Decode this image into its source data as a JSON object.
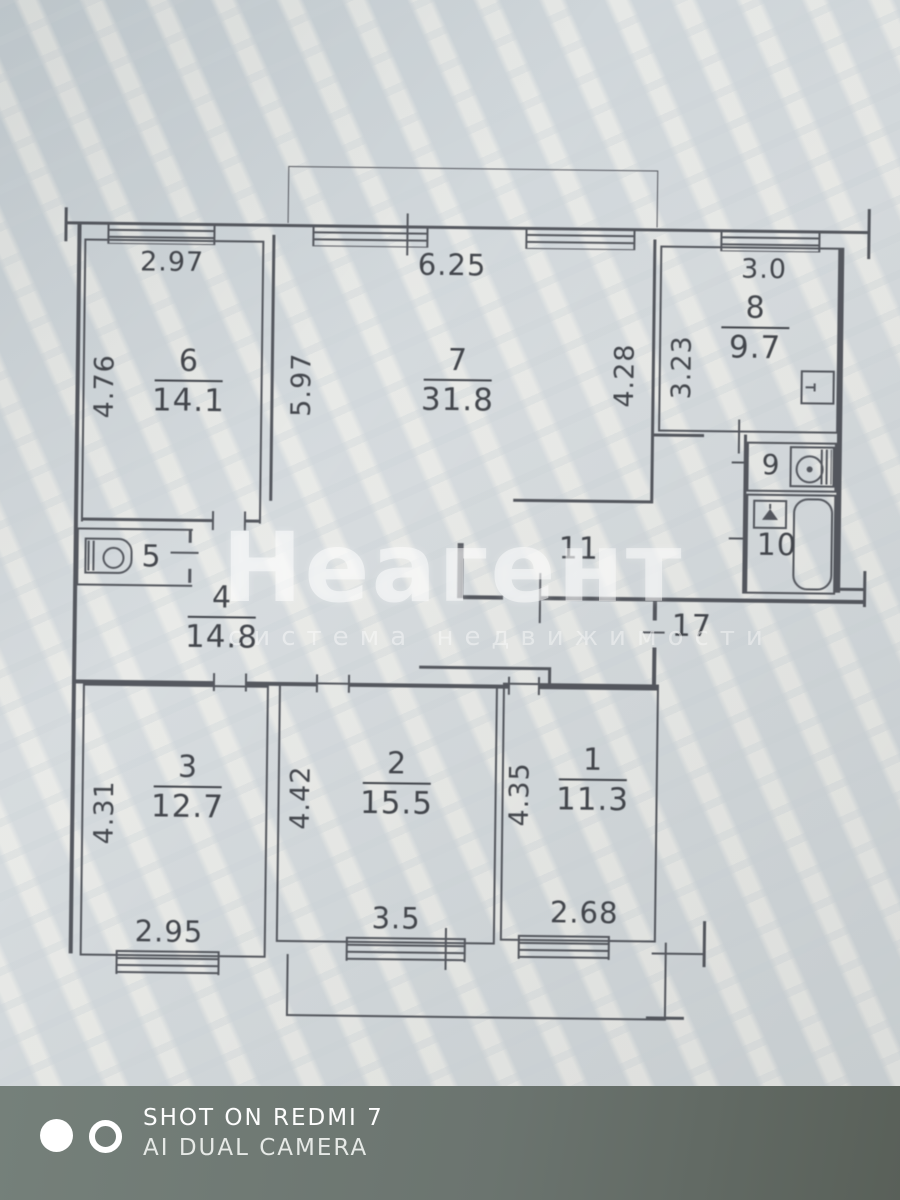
{
  "floorplan": {
    "rooms": {
      "r1": {
        "number": "1",
        "area": "11.3",
        "side": "4.35",
        "bottom": "2.68"
      },
      "r2": {
        "number": "2",
        "area": "15.5",
        "side": "4.42",
        "bottom": "3.5"
      },
      "r3": {
        "number": "3",
        "area": "12.7",
        "side": "4.31",
        "bottom": "2.95"
      },
      "r4": {
        "number": "4",
        "area": "14.8"
      },
      "r5": {
        "number": "5"
      },
      "r6": {
        "number": "6",
        "area": "14.1",
        "top": "2.97",
        "side": "4.76"
      },
      "r7": {
        "number": "7",
        "area": "31.8",
        "top": "6.25",
        "side": "5.97",
        "right": "4.28"
      },
      "r8": {
        "number": "8",
        "area": "9.7",
        "top": "3.0",
        "side": "3.23"
      },
      "r9": {
        "number": "9"
      },
      "r10": {
        "number": "10"
      },
      "r11": {
        "number": "11"
      },
      "r17": {
        "number": "17"
      }
    }
  },
  "watermarks": {
    "agency": {
      "title": "Неагент",
      "subtitle": "система недвижимости"
    },
    "camera": {
      "line1": "SHOT ON REDMI 7",
      "line2": "AI DUAL CAMERA"
    }
  },
  "colors": {
    "paper": "#d3dadd",
    "line": "#55585f",
    "table": "#6b746f",
    "watermark_white": "rgba(255,255,255,0.52)"
  }
}
